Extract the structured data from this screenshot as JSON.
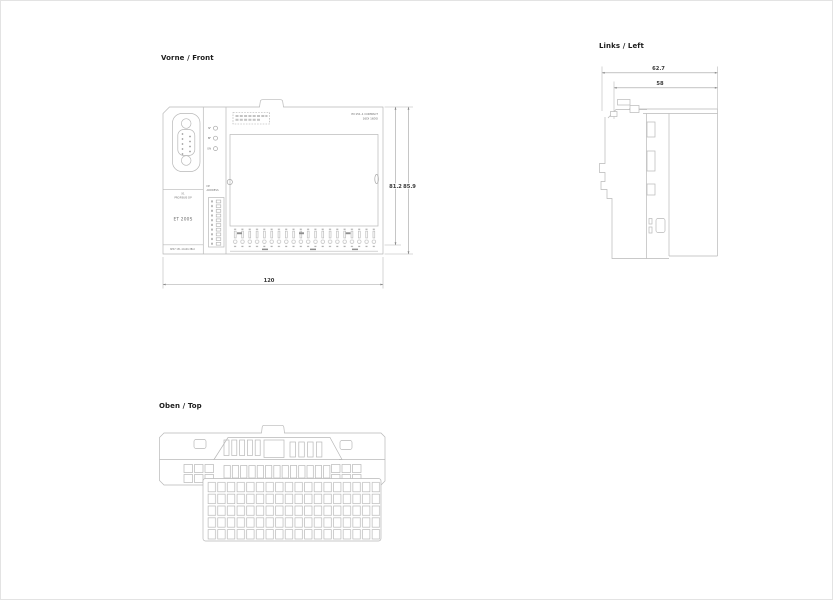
{
  "page": {
    "background": "#ffffff",
    "line_color": "#b8b8b8",
    "dimension_text_color": "#3a3a3a",
    "label_text_color": "#1c1c1c"
  },
  "views": {
    "front": {
      "label": "Vorne / Front",
      "module": {
        "interface_label_line1": "X1",
        "interface_label_line2": "PROFIBUS DP",
        "product_name": "ET 200S",
        "order_number": "6ES7 151-1CA00-3BL0",
        "dip_label_line1": "DP",
        "dip_label_line2": "ADDRESS",
        "type_line1": "IM 151-1 COMPACT",
        "type_line2": "16DI 16DO",
        "leds": [
          "SF",
          "BF",
          "ON"
        ]
      },
      "dimensions": {
        "width": "120",
        "height_body": "81.2",
        "height_total": "85.9"
      }
    },
    "left": {
      "label": "Links / Left",
      "dimensions": {
        "depth_total": "62.7",
        "depth_body": "58"
      }
    },
    "top": {
      "label": "Oben / Top"
    }
  }
}
